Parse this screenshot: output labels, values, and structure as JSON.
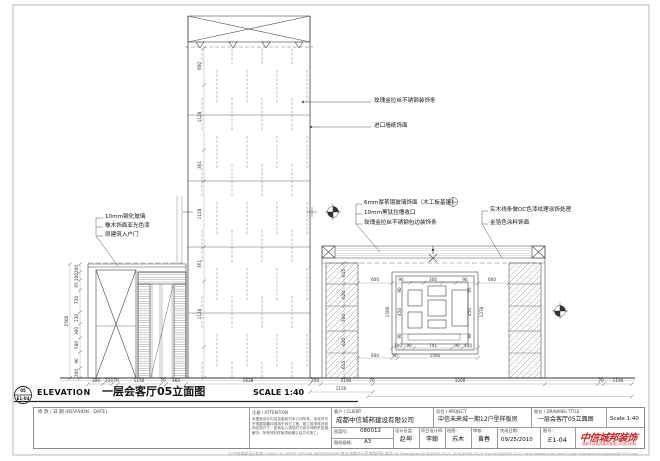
{
  "sheet": {
    "symbol_top": "05",
    "symbol_bottom": "E1-04",
    "elevation_label": "ELEVATION",
    "drawing_title": "一层会客厅05立面图",
    "scale_label": "SCALE 1:40"
  },
  "ann": {
    "shaft_right": [
      "玫瑰金拉丝不锈钢装饰条",
      "进口墙纸饰面"
    ],
    "door_left": [
      "10mm钢化玻璃",
      "橡木饰面亚光色漆",
      "原建筑入户门"
    ],
    "center": [
      "6mm厚茶镜玻璃饰面（木工板基层）",
      "10mm黑钛拉槽收口",
      "玫瑰金拉丝不锈钢包边装饰条"
    ],
    "wall_right": [
      "实木线条做OC色漆纹理涂饰处理",
      "金箔色涂料饰面"
    ]
  },
  "dims": {
    "shaft": [
      "600",
      "1128",
      "361",
      "1128",
      "361",
      "1128"
    ],
    "door": [
      "200",
      "100",
      "65",
      "730",
      "130",
      "300",
      "580",
      "90",
      "200"
    ],
    "door_total": "2500",
    "column": [
      "615",
      "620",
      "700",
      "620",
      "615"
    ],
    "feature_top": [
      "600",
      "90",
      "300",
      "90",
      "600"
    ],
    "feature_bottom1": [
      "100",
      "90",
      "741",
      "90",
      "400"
    ],
    "feature_bottom2": [
      "600",
      "90",
      "1592"
    ],
    "feature_left": [
      "90",
      "450",
      "90"
    ],
    "feature_right": [
      "95",
      "450",
      "90"
    ],
    "feature_left_total": "1500",
    "feature_right_total": "1278",
    "bottom": [
      "300",
      "210",
      "70",
      "1150",
      "70",
      "360",
      "1638",
      "250",
      "1190",
      "70",
      "3200",
      "70",
      "1190"
    ],
    "bottom_total": "1150"
  },
  "titleblock": {
    "revision_label": "修 改 / 日 期 (REVISION · DATE)",
    "attention_label": "注意 / ATTENTION",
    "attention_text": "本图纸设计内容及版权归本公司所有，未经许可不得复制翻印或用于其它工程。施工前须核对现场实际尺寸，如有出入请及时与设计师联系协调解决，所有材料样板须经确认后方可施工。",
    "client_label": "客户 / CLIENT",
    "client_value": "成都中信城邦建设有限公司",
    "project_label": "项目 / PROJECT",
    "project_value": "中信未来城一期12户型样板房",
    "title_label": "图名 / DRAWING TITLE",
    "title_value": "一层会客厅05立面图",
    "scale_value": "Scale 1:40",
    "file_no_label": "档案号:",
    "file_no_value": "080012",
    "size_label": "图纸规格:",
    "size_value": "A3",
    "roles": [
      {
        "label": "设计总监:",
        "value": "赵坤"
      },
      {
        "label": "项目设计师:",
        "value": "李翰"
      },
      {
        "label": "绘图:",
        "value": "苏木"
      },
      {
        "label": "审核:",
        "value": "黄春"
      }
    ],
    "date_label": "完成日期:",
    "date_value": "09/25/2010",
    "dwg_no_label": "图号:",
    "dwg_no_value": "E1-04",
    "logo_main": "中信城邦装饰",
    "logo_sub": "成都中信城邦建设有限公司设计机构",
    "footer": "注:中信城邦设计机构 CHINA LN CREST DESIGN PARTNERSHIP 地址:成都市人民南路四段 电话:14 Telephone:(028)8280-3172 (028)8280-3179 Fax:(028)8280-3121 http://www.cndy.com E-mail:zhongxinchengbang@163.com"
  },
  "colors": {
    "line": "#444",
    "accent_red": "#cc2222",
    "hatch": "#8a8a8a"
  }
}
